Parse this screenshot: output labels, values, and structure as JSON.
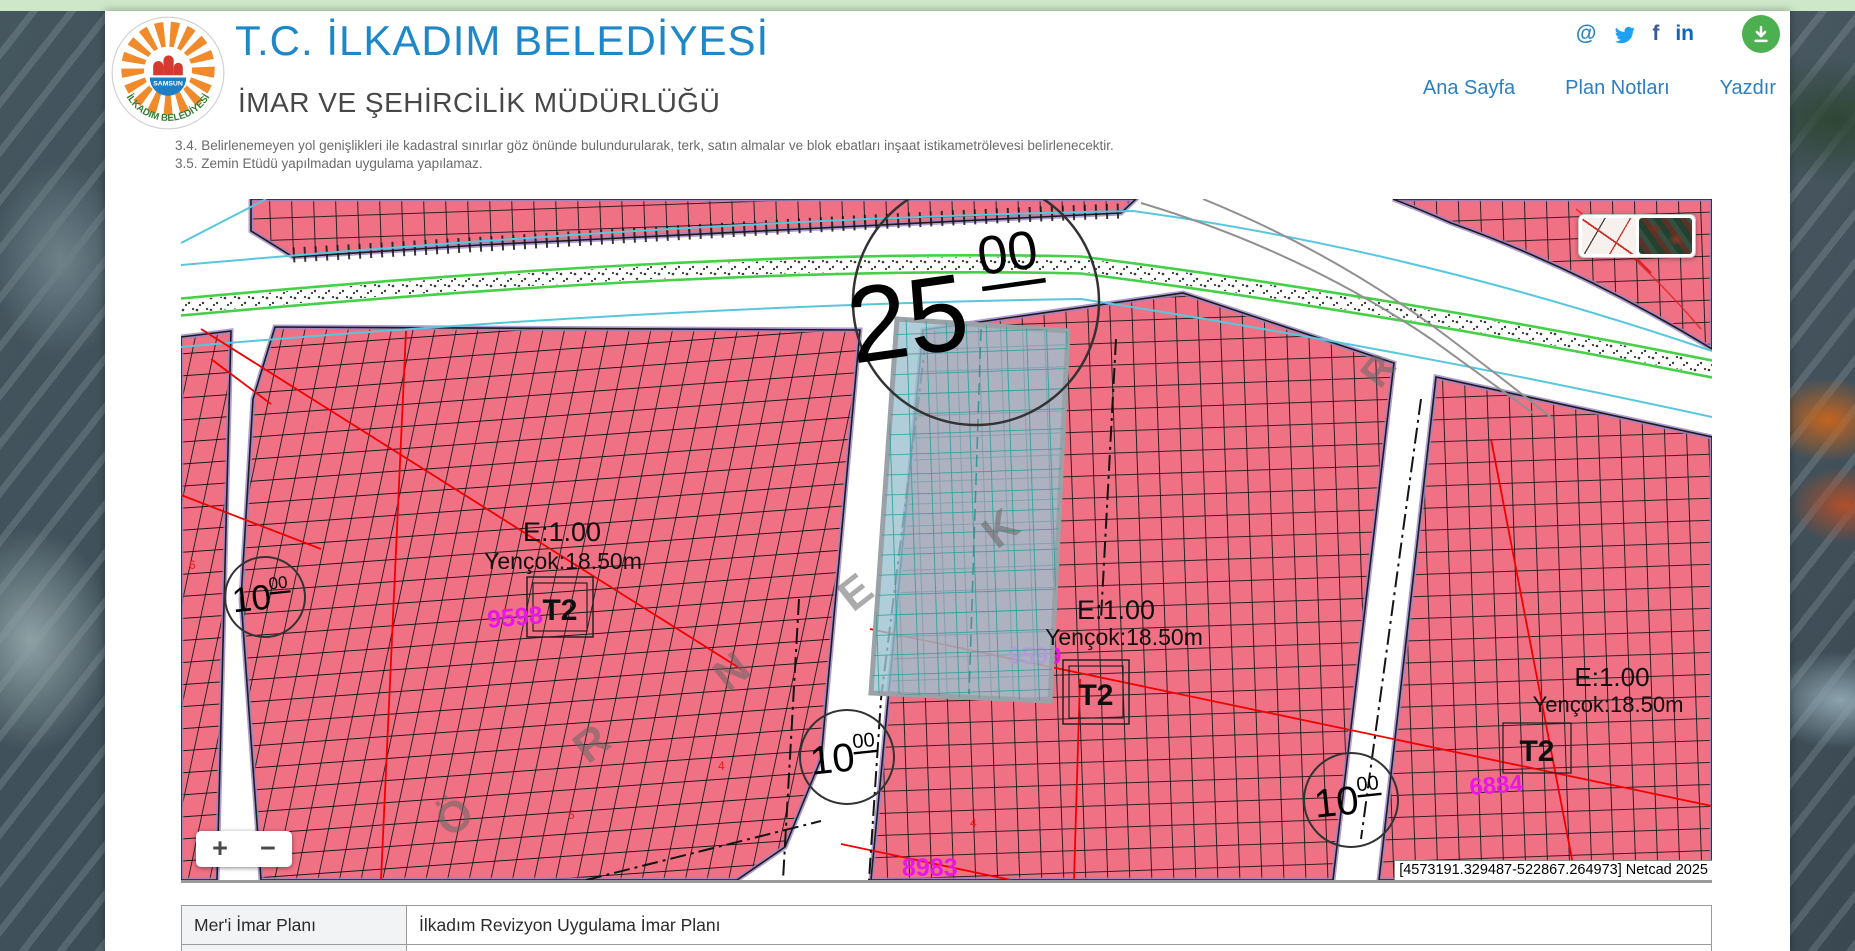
{
  "header": {
    "title": "T.C. İLKADIM BELEDİYESİ",
    "subtitle": "İMAR VE ŞEHİRCİLİK MÜDÜRLÜĞÜ",
    "logo": {
      "city": "SAMSUN",
      "ring_text": "İLKADIM BELEDİYESİ"
    },
    "social": {
      "email_glyph": "@",
      "facebook_glyph": "f",
      "linkedin_glyph": "in"
    },
    "nav": [
      {
        "label": "Ana Sayfa"
      },
      {
        "label": "Plan Notları"
      },
      {
        "label": "Yazdır"
      }
    ]
  },
  "notes": [
    "3.4. Belirlenemeyen yol genişlikleri ile kadastral sınırlar göz önünde bulundurularak, terk, satın almalar ve blok ebatları inşaat istikametrölevesi belirlenecektir.",
    "3.5. Zemin Etüdü yapılmadan uygulama yapılamaz."
  ],
  "map": {
    "road_width_main": {
      "big": "25",
      "sup": "00"
    },
    "road_width_small": {
      "big": "10",
      "sup": "00"
    },
    "zones": [
      {
        "e": "E:1.00",
        "yencok": "Yençok:18.50m",
        "t": "T2",
        "parcel_no": "9598"
      },
      {
        "e": "E:1.00",
        "yencok": "Yençok:18.50m",
        "t": "T2",
        "parcel_no": "9599"
      },
      {
        "e": "E:1.00",
        "yencok": "Yençok:18.50m",
        "t": "T2",
        "parcel_no": "6884"
      }
    ],
    "extra_parcel_no": "8983",
    "street_letters": [
      "Ö",
      "R",
      "N",
      "E",
      "K"
    ],
    "street_letter_ne": "R",
    "tiny_marks": [
      "5",
      "4",
      "6",
      "4"
    ],
    "coords": "[4573191.329487-522867.264973] Netcad 2025",
    "controls": {
      "zoom_in": "+",
      "zoom_out": "−"
    },
    "colors": {
      "zone_pink": "#ef7183",
      "parcel_teal": "#9cc2cf",
      "teal_grid": "#1fa396",
      "purple_border": "#9b85c8",
      "green_line": "#45d048",
      "cyan_line": "#58c7de",
      "magenta": "#e817e8"
    }
  },
  "table": {
    "rows": [
      {
        "label": "Mer'i İmar Planı",
        "value": "İlkadım Revizyon Uygulama İmar Planı"
      },
      {
        "label": "",
        "value": ""
      }
    ]
  }
}
